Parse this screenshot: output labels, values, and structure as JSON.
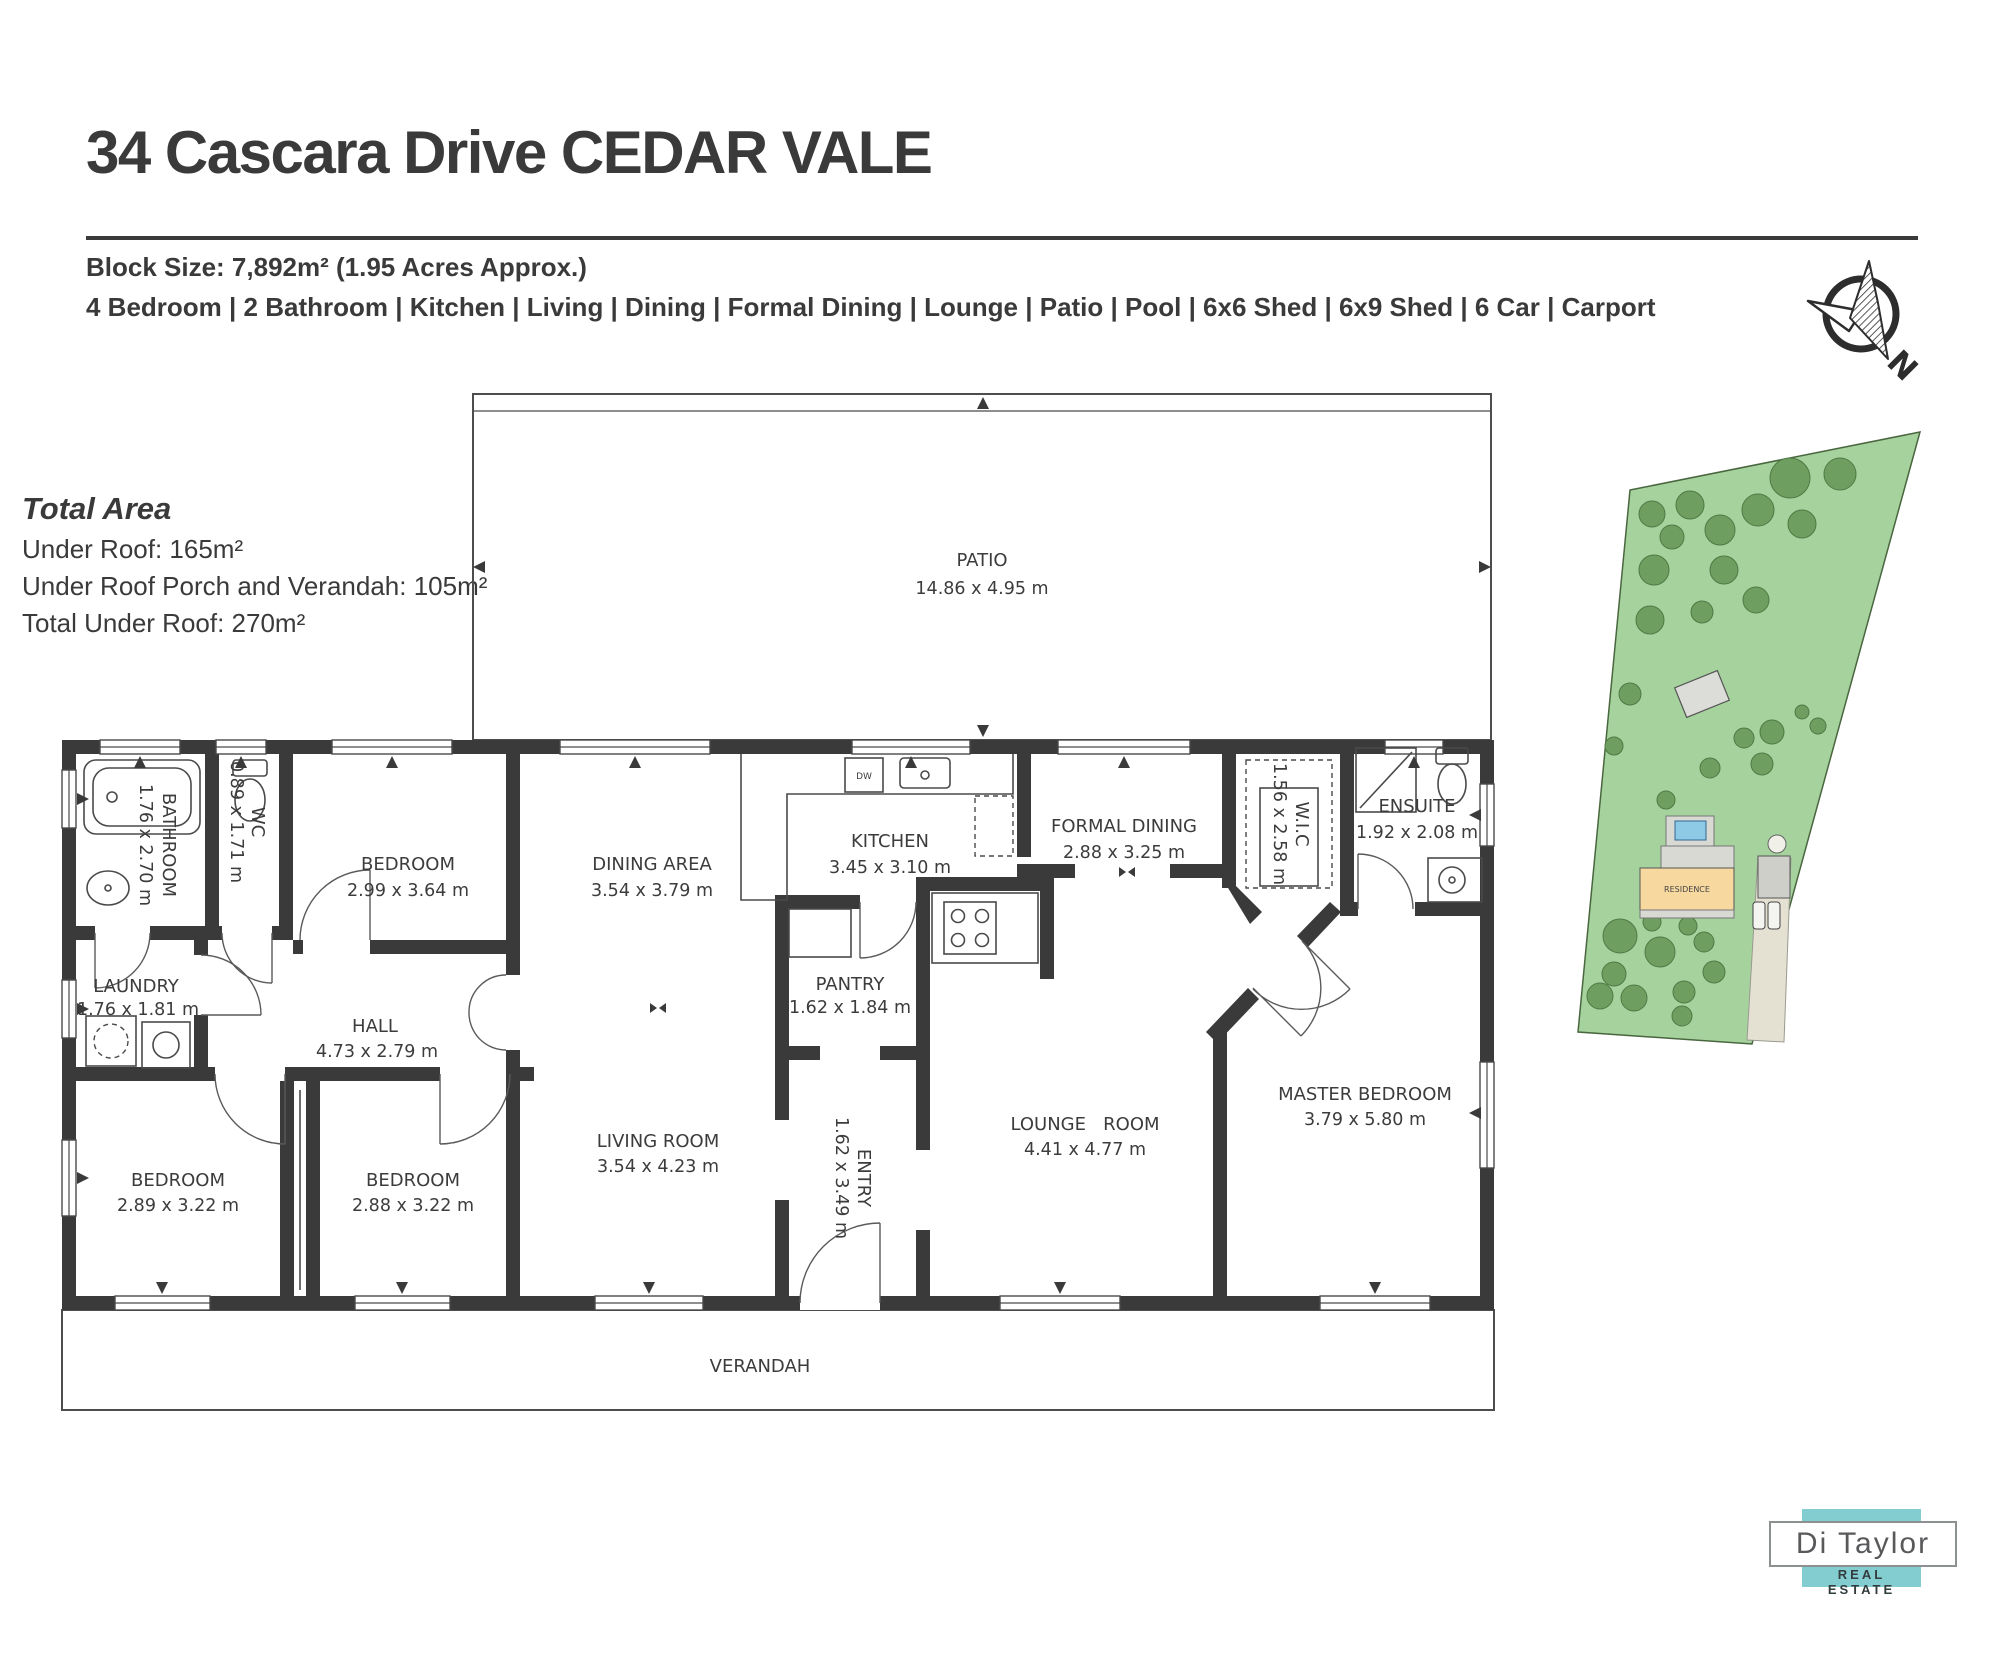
{
  "header": {
    "title": "34 Cascara Drive CEDAR VALE",
    "block_size": "Block Size: 7,892m² (1.95 Acres Approx.)",
    "features": "4 Bedroom | 2 Bathroom | Kitchen | Living | Dining | Formal Dining | Lounge | Patio | Pool | 6x6 Shed | 6x9 Shed | 6 Car | Carport"
  },
  "total_area": {
    "heading": "Total Area",
    "under_roof": "Under Roof: 165m²",
    "porch_verandah": "Under Roof Porch and Verandah: 105m²",
    "total": "Total Under Roof: 270m²"
  },
  "rooms": [
    {
      "name": "PATIO",
      "dims": "14.86 x 4.95 m"
    },
    {
      "name": "BATHROOM",
      "dims": "1.76 x 2.70 m"
    },
    {
      "name": "WC",
      "dims": "0.89 x 1.71 m"
    },
    {
      "name": "BEDROOM",
      "dims": "2.99 x 3.64 m"
    },
    {
      "name": "DINING AREA",
      "dims": "3.54 x 3.79 m"
    },
    {
      "name": "KITCHEN",
      "dims": "3.45 x 3.10 m"
    },
    {
      "name": "FORMAL DINING",
      "dims": "2.88 x 3.25 m"
    },
    {
      "name": "W.I.C",
      "dims": "1.56 x 2.58 m"
    },
    {
      "name": "ENSUITE",
      "dims": "1.92 x 2.08 m"
    },
    {
      "name": "LAUNDRY",
      "dims": "1.76 x 1.81 m"
    },
    {
      "name": "HALL",
      "dims": "4.73 x 2.79 m"
    },
    {
      "name": "PANTRY",
      "dims": "1.62 x 1.84 m"
    },
    {
      "name": "LIVING ROOM",
      "dims": "3.54 x 4.23 m"
    },
    {
      "name": "ENTRY",
      "dims": "1.62 x 3.49 m"
    },
    {
      "name": "LOUNGE   ROOM",
      "dims": "4.41 x 4.77 m"
    },
    {
      "name": "MASTER BEDROOM",
      "dims": "3.79 x 5.80 m"
    },
    {
      "name": "BEDROOM",
      "dims": "2.89 x 3.22 m"
    },
    {
      "name": "BEDROOM",
      "dims": "2.88 x 3.22 m"
    },
    {
      "name": "VERANDAH",
      "dims": ""
    }
  ],
  "fixtures": {
    "dishwasher": "DW"
  },
  "site_plan": {
    "residence_label": "RESIDENCE"
  },
  "compass": {
    "north": "N"
  },
  "logo": {
    "brand": "Di Taylor",
    "tagline": "REAL ESTATE"
  },
  "colors": {
    "wall": "#3a3a3a",
    "line": "#4a4a4a",
    "land": "#a6d29e",
    "tree": "#6f9f60",
    "residence_fill": "#f7d9a0",
    "pool": "#8ecae6",
    "paving": "#d9d9d4",
    "driveway": "#e4e1d2",
    "logo_teal": "#83cdd0",
    "text": "#3a3a3a"
  }
}
